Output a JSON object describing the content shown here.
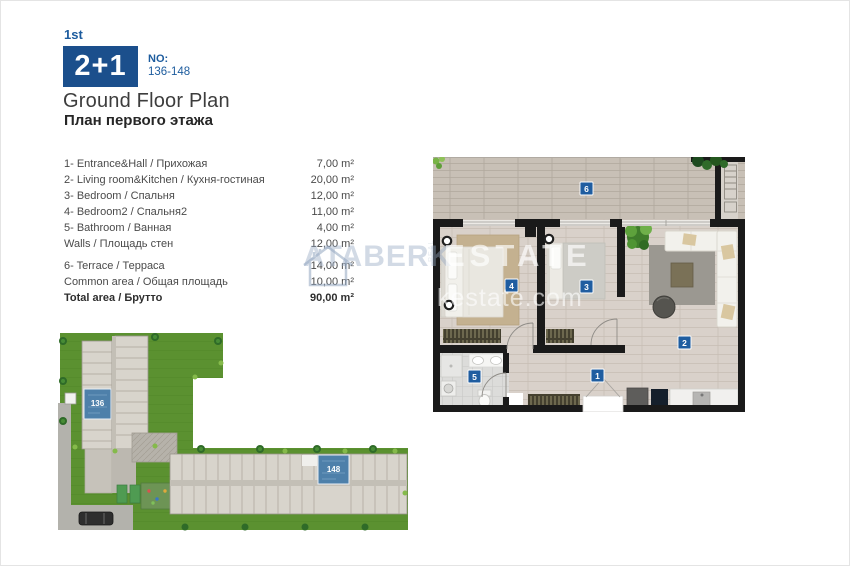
{
  "header": {
    "floor_label": "1st",
    "unit_type": "2+1",
    "no_label": "NO:",
    "no_value": "136-148",
    "title_en": "Ground Floor Plan",
    "title_ru": "План первого этажа"
  },
  "rooms": [
    {
      "label": "1- Entrance&Hall / Прихожая",
      "area": "7,00 m²"
    },
    {
      "label": "2- Living room&Kitchen / Кухня-гостиная",
      "area": "20,00 m²"
    },
    {
      "label": "3- Bedroom / Спальня",
      "area": "12,00 m²"
    },
    {
      "label": "4- Bedroom2 / Спальня2",
      "area": "11,00 m²"
    },
    {
      "label": "5- Bathroom / Ванная",
      "area": "4,00 m²"
    },
    {
      "label": "Walls / Площадь стен",
      "area": "12,00 m²"
    }
  ],
  "summary": [
    {
      "label": "6- Terrace / Терраса",
      "area": "14,00 m²"
    },
    {
      "label": "Common area / Общая площадь",
      "area": "10,00 m²"
    },
    {
      "label": "Total area / Брутто",
      "area": "90,00 m²"
    }
  ],
  "floorplan": {
    "badge_1": "1",
    "badge_2": "2",
    "badge_3": "3",
    "badge_4": "4",
    "badge_5": "5",
    "badge_6": "6"
  },
  "siteplan": {
    "unit_a": "136",
    "unit_b": "148"
  },
  "watermark": {
    "brand_left": "ATABERK",
    "brand_right": "ESTATE",
    "vertical_text": "REAL",
    "domain": "kestate.com"
  },
  "colors": {
    "accent_blue": "#1b4f8c",
    "badge_blue": "#1f5da0",
    "unit_blue": "#4e80aa",
    "grass_green": "#5b9130"
  }
}
